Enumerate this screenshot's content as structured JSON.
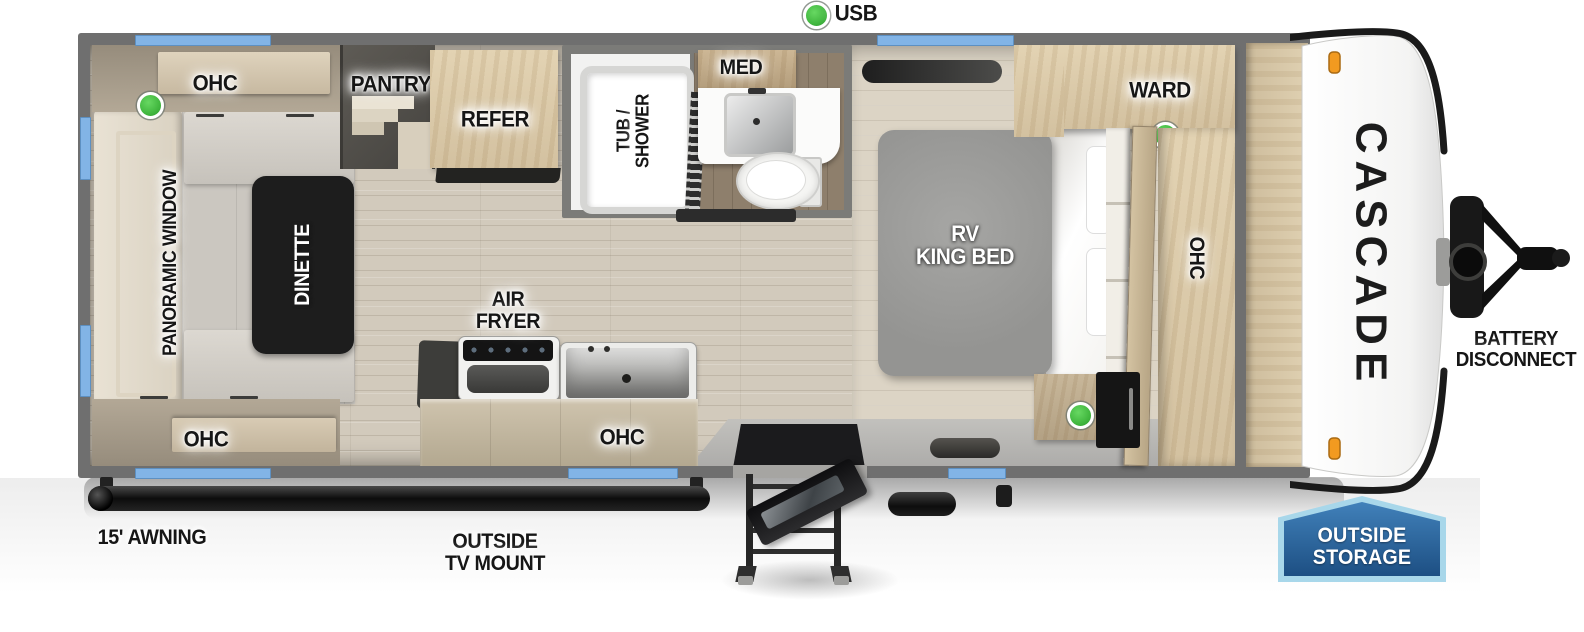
{
  "colors": {
    "wall": "#6f6f6f",
    "window_blue": "#82b4e6",
    "floor": "#d2cabc",
    "accent_green": "#3fb53d",
    "marker_orange": "#f29a20",
    "badge_blue_dark": "#1d4f83",
    "badge_blue_light": "#a8d7ea",
    "brand_text": "#1c1c1c"
  },
  "top": {
    "usb": "USB"
  },
  "living": {
    "ohc_top": "OHC",
    "ohc_bottom": "OHC",
    "panoramic_window": "PANORAMIC WINDOW",
    "dinette": "DINETTE"
  },
  "kitchen": {
    "pantry": "PANTRY",
    "refer": "REFER",
    "air_fryer_1": "AIR",
    "air_fryer_2": "FRYER",
    "ohc": "OHC"
  },
  "bath": {
    "tub_shower_1": "TUB /",
    "tub_shower_2": "SHOWER",
    "med": "MED"
  },
  "bedroom": {
    "bed_1": "RV",
    "bed_2": "KING BED",
    "ward": "WARD",
    "ohc": "OHC"
  },
  "exterior": {
    "awning": "15' AWNING",
    "tv_mount_1": "OUTSIDE",
    "tv_mount_2": "TV MOUNT",
    "battery_1": "BATTERY",
    "battery_2": "DISCONNECT",
    "storage_1": "OUTSIDE",
    "storage_2": "STORAGE",
    "brand": "CASCADE"
  }
}
